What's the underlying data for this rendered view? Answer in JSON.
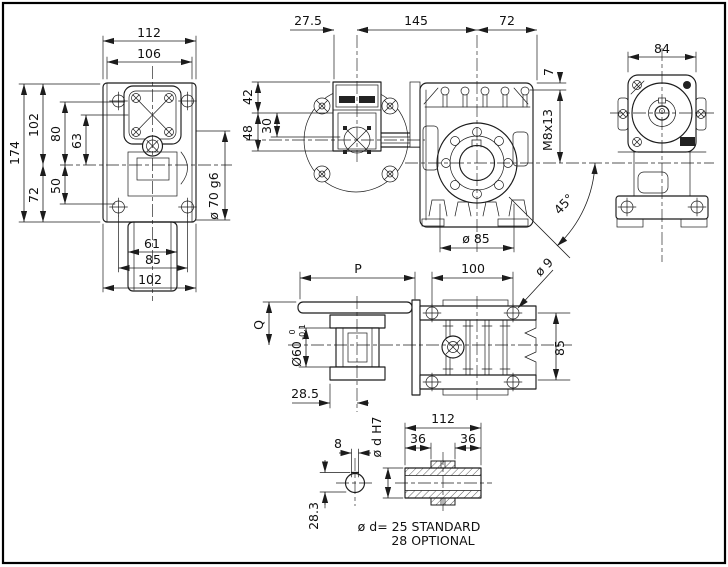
{
  "colors": {
    "line": "#1c1c1c",
    "background": "#ffffff"
  },
  "views": {
    "front": {
      "dims": {
        "d112": "112",
        "d106": "106",
        "d174": "174",
        "d102": "102",
        "d80": "80",
        "d63": "63",
        "d72": "72",
        "d50": "50",
        "d61": "61",
        "d85": "85",
        "d102b": "102",
        "hub": "ø 70 g6"
      }
    },
    "side": {
      "dims": {
        "d27_5": "27.5",
        "d145": "145",
        "d72": "72",
        "d42": "42",
        "d30": "30",
        "d48": "48",
        "d7": "7",
        "thread": "M8x13",
        "angle": "45°",
        "flange": "ø 85"
      }
    },
    "end": {
      "dims": {
        "d84": "84"
      }
    },
    "output": {
      "dims": {
        "P": "P",
        "d100": "100",
        "d9": "ø 9",
        "Q": "Q",
        "d60": "Ø60",
        "tol_hi": "0",
        "tol_lo": "-0.1",
        "d85": "85",
        "d28_5": "28.5"
      }
    },
    "shaft": {
      "dims": {
        "d8": "8",
        "d28_3": "28.3",
        "bore": "ø d H7",
        "d112": "112",
        "d36a": "36",
        "d36b": "36"
      },
      "note1": "ø d= 25 STANDARD",
      "note2": "28 OPTIONAL"
    }
  }
}
